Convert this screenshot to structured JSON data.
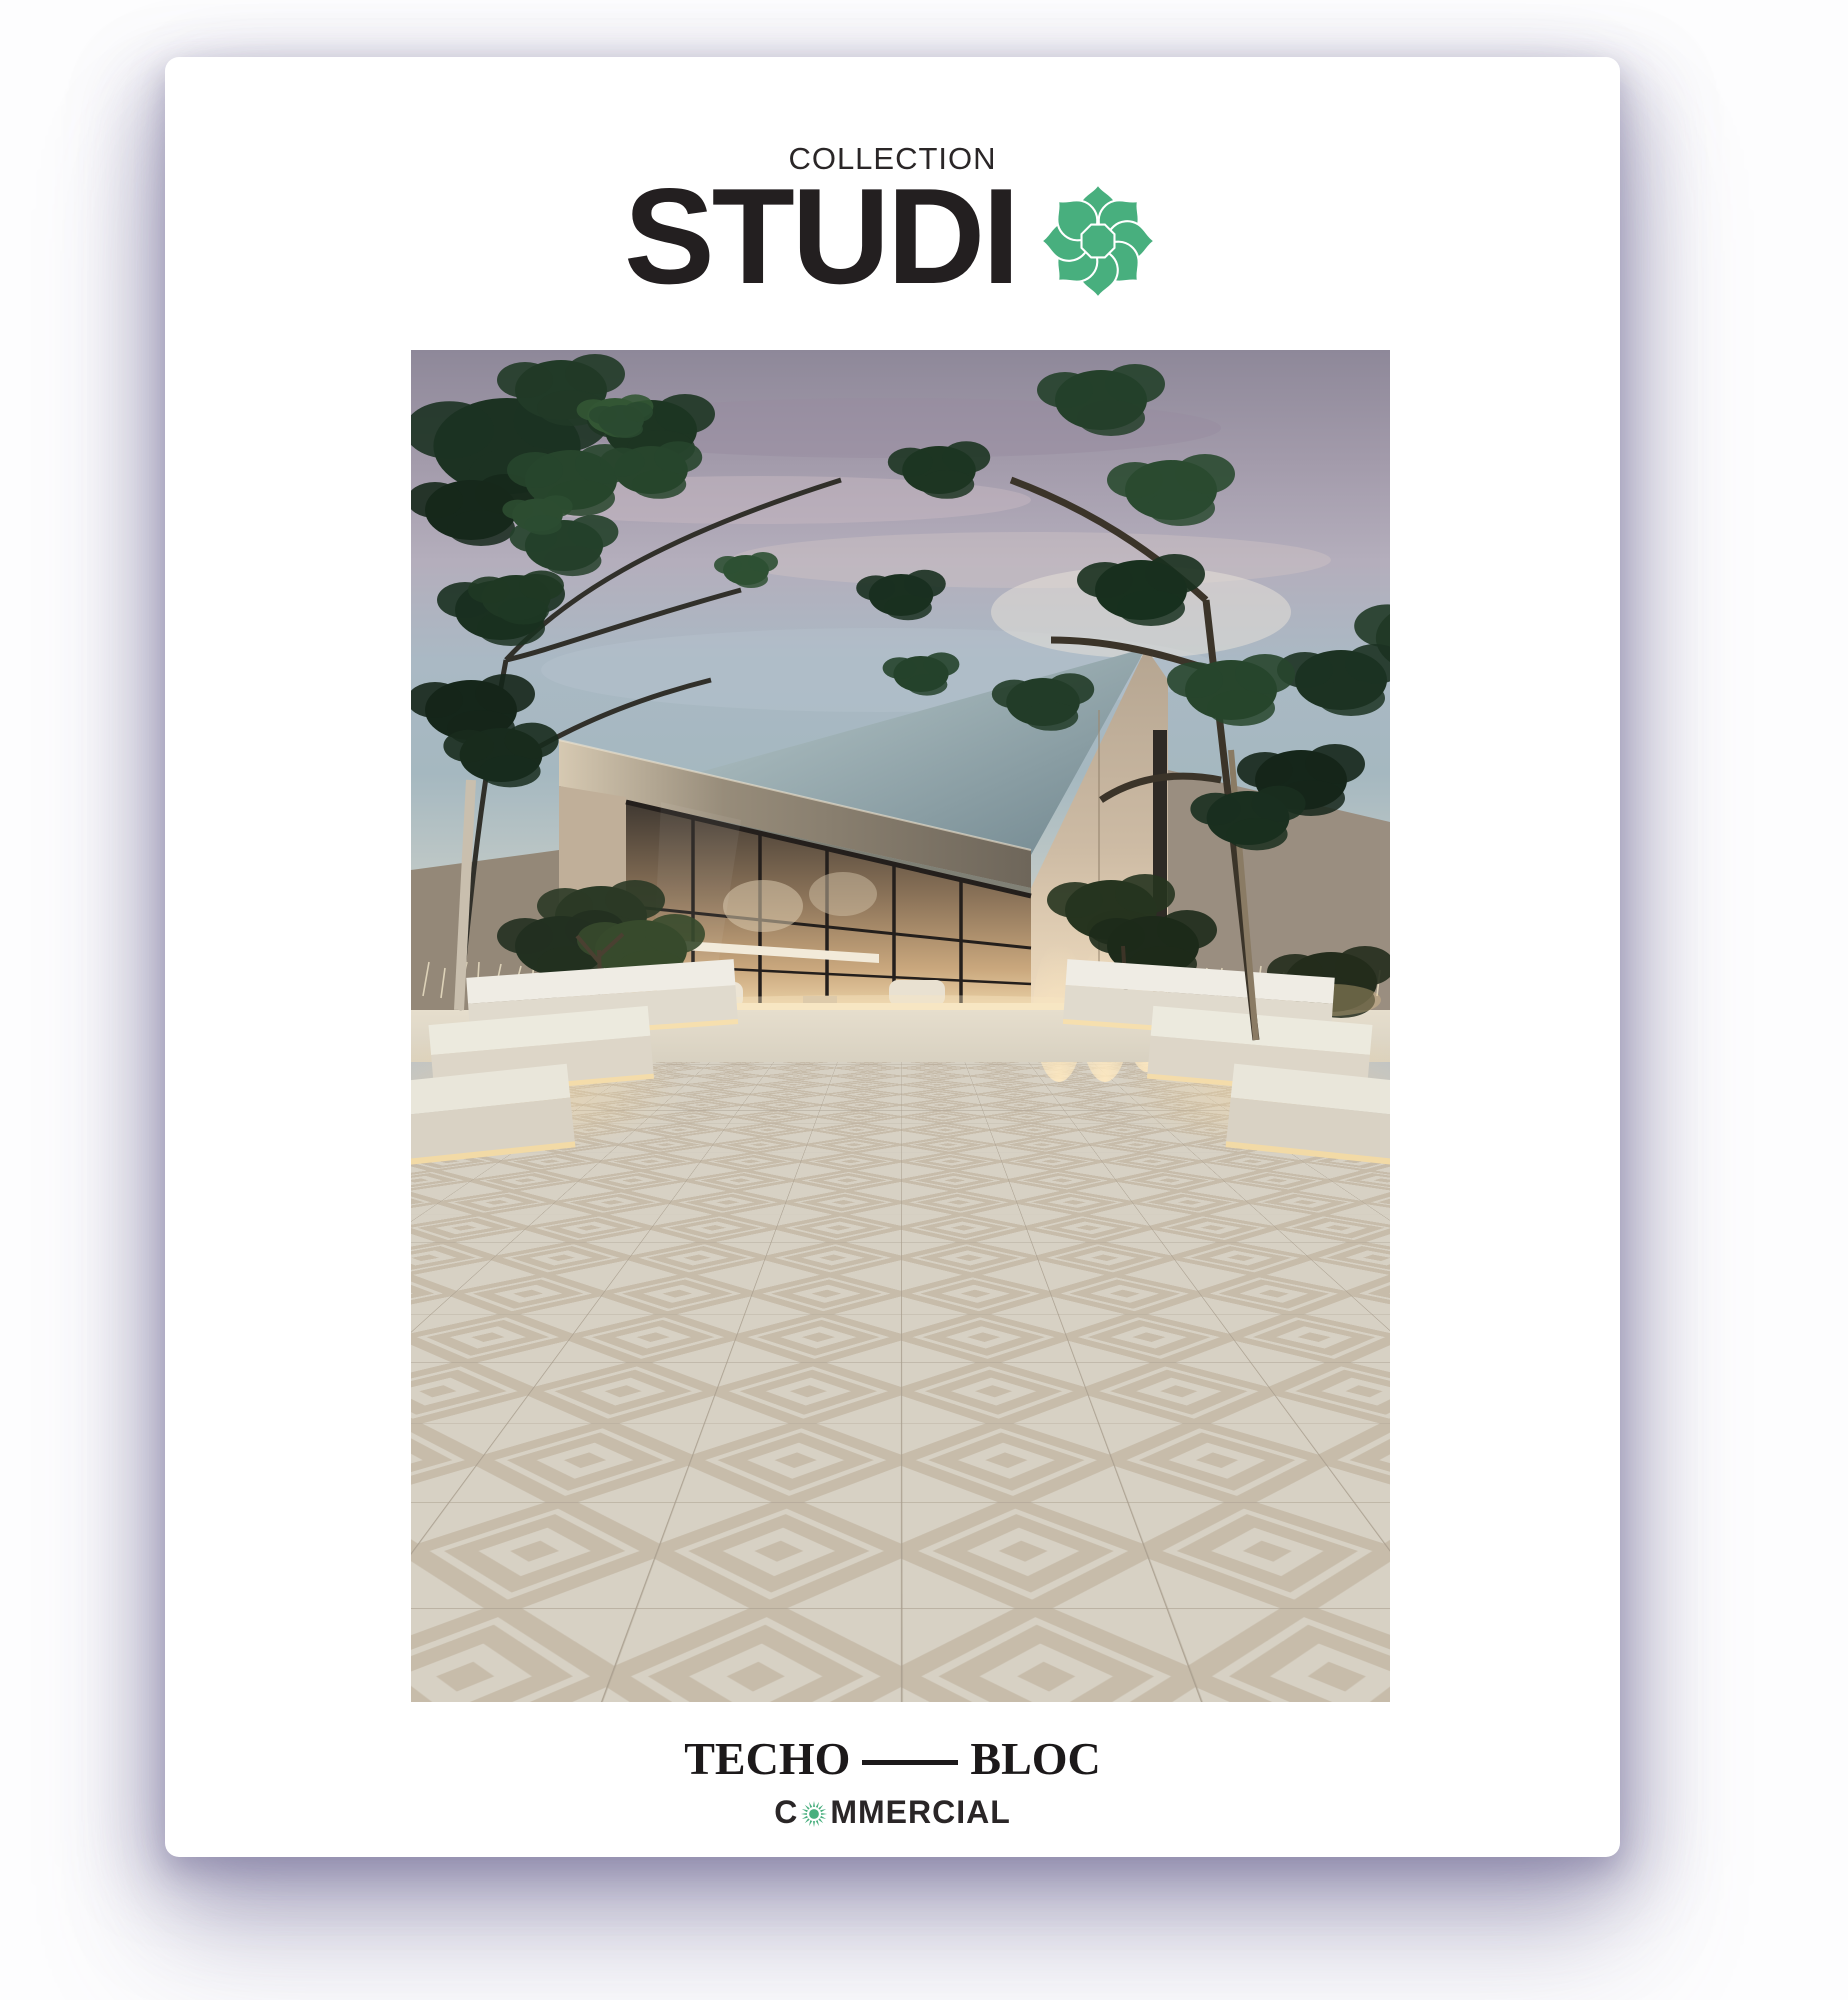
{
  "colors": {
    "brand_green": "#48AF7E",
    "ink": "#231F20",
    "paper": "#FFFFFF"
  },
  "masthead": {
    "kicker": "COLLECTION",
    "wordmark_text": "STUDI",
    "flower_icon": "eight-petal-rosette"
  },
  "photo": {
    "alt": "Modern angular stone pavilion at dusk with glowing glass wall, trees, white benches and a plaza of diamond-patterned pavers"
  },
  "footer": {
    "brand_left": "TECHO",
    "brand_right": "BLOC",
    "commercial_prefix": "C",
    "commercial_suffix": "MMERCIAL",
    "sun_icon": "sunburst"
  }
}
